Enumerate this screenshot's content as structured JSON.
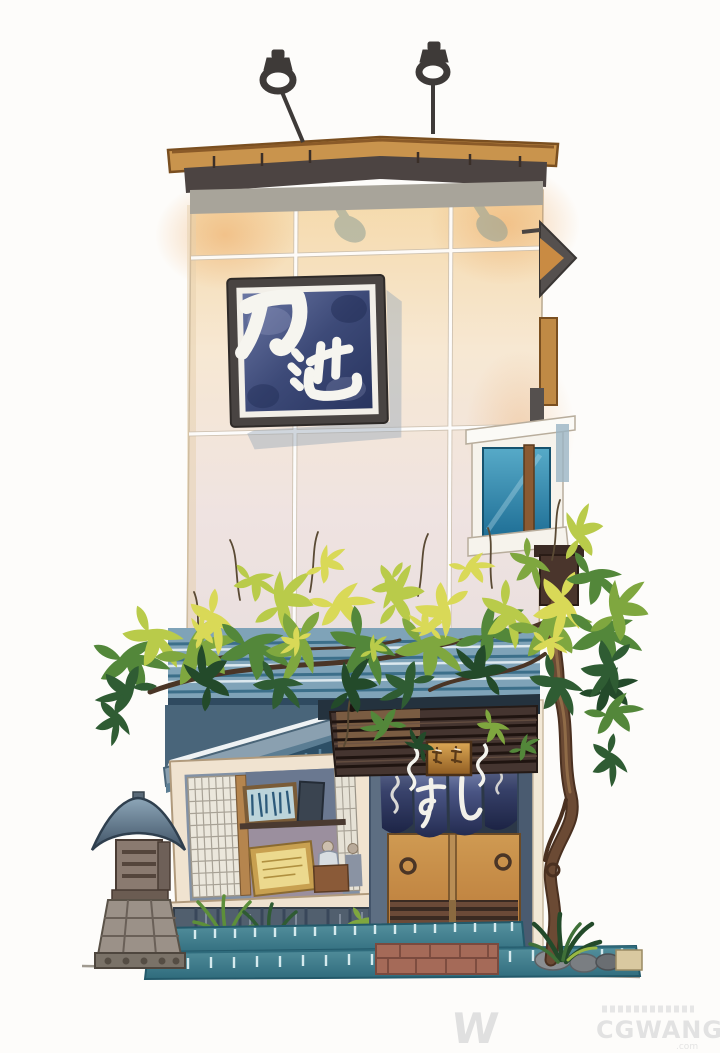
{
  "artwork": {
    "type": "watercolor illustration",
    "subject": "two-story Japanese sushi shop storefront with overgrown vines, stone lantern and hanging noren curtain",
    "main_sign_text": "乃池",
    "noren_text": "すし",
    "noren_char_left": "す",
    "noren_char_right": "し"
  },
  "watermark": {
    "logo_letter": "W",
    "brand": "CGWANG",
    "suffix": ".com"
  },
  "palette": {
    "roof_tan": "#c9944d",
    "wall_peach": "#f6ddb2",
    "sign_navy": "#2c3a68",
    "window_teal": "#2a7fa6",
    "leaf_yellow": "#d9d957",
    "leaf_green": "#53873a",
    "facade_blue": "#4a7f9c",
    "noren_navy": "#2b3460",
    "door_wood": "#c88f49",
    "base_teal": "#4b8b99"
  }
}
